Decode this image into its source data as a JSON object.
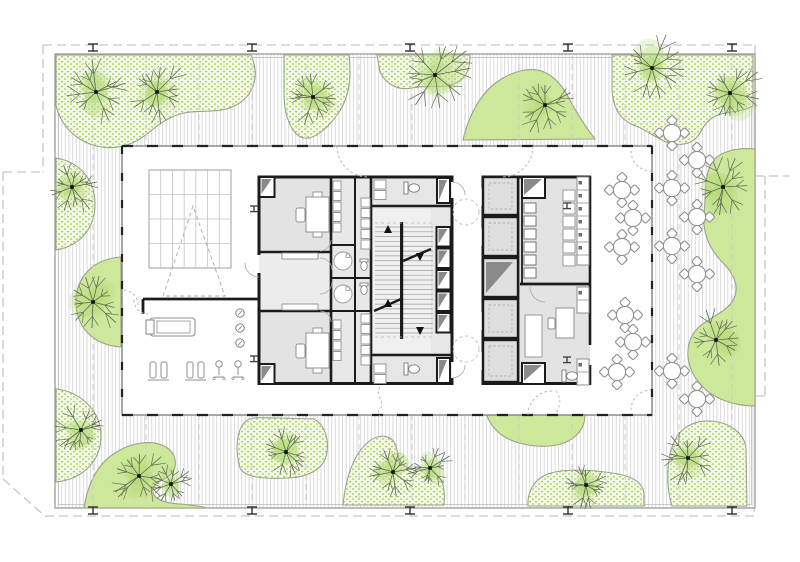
{
  "meta": {
    "drawing_type": "architectural-floor-plan",
    "view": "typical tower floor with landscaped roof terrace",
    "canvas": {
      "w": 800,
      "h": 562
    }
  },
  "palette": {
    "paper": "#ffffff",
    "hatch_line": "#d5d5d5",
    "deck_edge": "#9b9b9b",
    "deck_edge_inner": "#bdbdbd",
    "property_line": "#c6c6c6",
    "grid_dash": "#cccccc",
    "wall_black": "#1b1b1b",
    "facade_gray": "#8a8a8a",
    "facade_dash": "#222222",
    "room_gray": "#e3e3e3",
    "room_gray_light": "#ececec",
    "stair_fill": "#f0f0f0",
    "furniture_stroke": "#8f8f8f",
    "light_stroke": "#aaaaaa",
    "shaft_dark": "#8a8a8a",
    "arc_dash": "#b8b8b8",
    "green_solid": "#cde79b",
    "green_edge": "#9aa389",
    "stipple_bg": "#f3f8e6",
    "stipple_dot": "#a6cf60",
    "tree_branch": "#5d6750",
    "tree_canopy": "#b7db7a",
    "column_dark": "#2f2f2f"
  },
  "site": {
    "deck": {
      "x": 55,
      "y": 54,
      "w": 700,
      "h": 454
    },
    "property_segments": [
      "M43,45 H755",
      "M755,45 V176",
      "M755,176 H790",
      "M765,176 V396",
      "M765,396 H754",
      "M754,396 V512",
      "M45,516 H754",
      "M43,45 V172",
      "M3,172 H43",
      "M3,172 V479",
      "M3,479 L46,517"
    ],
    "grid_xs": [
      93,
      146,
      199,
      252,
      306,
      359,
      412,
      465,
      519,
      572,
      625,
      679,
      732
    ],
    "perimeter_columns": {
      "xs": [
        93,
        252,
        410,
        568,
        732
      ],
      "top_y": 44,
      "bottom_y": 507
    }
  },
  "landscape": {
    "stipple_areas": [
      "M56,55 L251,55 C260,76 254,94 238,104 C216,117 196,106 172,117 C150,127 144,143 118,147 C92,151 64,136 56,106 Z",
      "M284,55 L349,55 C352,80 348,99 339,112 C330,126 315,140 304,138 C292,136 284,116 284,94 Z",
      "M377,55 L470,55 C470,66 468,76 458,82 C444,90 428,84 412,88 C398,91 386,84 380,72 Z",
      "M612,55 L753,55 L753,106 C738,114 724,110 712,118 C700,126 702,138 688,143 C668,150 652,132 636,126 C618,120 612,104 612,86 Z",
      "M56,158 C80,162 95,180 95,204 C95,228 80,246 56,250 Z",
      "M56,389 C82,392 101,412 101,436 C101,460 84,479 56,482 Z",
      "M240,468 C235,450 236,430 246,421 C252,416 264,418 278,418 L314,419 C324,424 329,438 327,452 C325,468 310,477 288,478 C266,479 245,478 240,468 Z",
      "M343,505 C345,484 351,458 366,444 C376,434 388,434 394,442 C399,449 396,458 402,464 C410,472 428,466 438,476 C444,482 445,494 444,505 Z",
      "M528,506 C527,492 534,479 548,474 C564,468 592,470 612,473 C634,476 644,484 644,495 L644,506 Z",
      "M672,506 C666,488 666,460 674,442 C680,428 694,420 710,421 C728,422 744,432 746,448 L747,506 Z"
    ],
    "solid_areas": [
      "M463,140 C468,118 480,92 500,80 C512,72 530,66 544,72 C558,78 566,92 572,104 C580,118 588,130 595,139 Z",
      "M121,257 C92,259 76,278 76,302 C76,326 92,345 121,347 Z",
      "M84,508 C87,488 95,467 112,455 C130,442 152,439 166,447 C176,453 178,465 172,473 C166,480 155,481 153,489 C151,497 161,503 180,504 C192,505 201,506 206,508 Z",
      "M755,149 C736,147 716,152 710,166 C704,180 706,196 704,214 C702,236 712,252 724,264 C736,276 740,290 732,302 C722,316 700,320 692,336 C684,352 688,370 700,384 C714,400 736,406 755,406 Z",
      "M487,415 L585,415 C585,429 575,441 557,445 C535,449 509,443 497,431 C491,425 488,420 487,415 Z"
    ],
    "trees": [
      [
        96,
        92,
        34
      ],
      [
        157,
        92,
        34
      ],
      [
        313,
        97,
        30
      ],
      [
        435,
        75,
        40
      ],
      [
        545,
        105,
        32
      ],
      [
        652,
        68,
        36
      ],
      [
        730,
        93,
        36
      ],
      [
        72,
        187,
        28
      ],
      [
        93,
        302,
        32
      ],
      [
        81,
        430,
        28
      ],
      [
        139,
        476,
        30
      ],
      [
        171,
        484,
        24
      ],
      [
        286,
        452,
        28
      ],
      [
        393,
        472,
        28
      ],
      [
        430,
        468,
        24
      ],
      [
        586,
        485,
        24
      ],
      [
        688,
        458,
        30
      ],
      [
        723,
        187,
        32
      ],
      [
        716,
        340,
        32
      ]
    ]
  },
  "building": {
    "x": 122,
    "y": 146,
    "w": 530,
    "h": 269
  },
  "interior": {
    "fills": [
      [
        259,
        176,
        72,
        76,
        "#e3e3e3"
      ],
      [
        259,
        252,
        72,
        59,
        "#ececec"
      ],
      [
        259,
        311,
        72,
        74,
        "#e3e3e3"
      ],
      [
        331,
        176,
        40,
        209,
        "#e8e8e8"
      ],
      [
        371,
        176,
        81,
        209,
        "#e6e6e6"
      ],
      [
        373,
        209,
        58,
        144,
        "#f0f0f0"
      ],
      [
        483,
        176,
        107,
        209,
        "#e3e3e3"
      ]
    ],
    "walls": [
      [
        259,
        176,
        259,
        255,
        3
      ],
      [
        259,
        273,
        259,
        385,
        3
      ],
      [
        331,
        176,
        331,
        385,
        2.6
      ],
      [
        355,
        176,
        355,
        385,
        2
      ],
      [
        371,
        176,
        371,
        385,
        2.6
      ],
      [
        452,
        176,
        452,
        182,
        3
      ],
      [
        452,
        198,
        452,
        362,
        3
      ],
      [
        452,
        378,
        452,
        385,
        3
      ],
      [
        483,
        176,
        483,
        188,
        3
      ],
      [
        483,
        206,
        483,
        228,
        3
      ],
      [
        483,
        246,
        483,
        312,
        3
      ],
      [
        483,
        330,
        483,
        352,
        3
      ],
      [
        483,
        370,
        483,
        385,
        3
      ],
      [
        518,
        176,
        518,
        385,
        2.6
      ],
      [
        522,
        176,
        522,
        283,
        1.8
      ],
      [
        590,
        176,
        590,
        345,
        2.6
      ],
      [
        590,
        365,
        590,
        385,
        2.6
      ],
      [
        257.5,
        177,
        453.5,
        177,
        3
      ],
      [
        257.5,
        383.5,
        453.5,
        383.5,
        3
      ],
      [
        481.5,
        177,
        591,
        177,
        3
      ],
      [
        481.5,
        383.5,
        591,
        383.5,
        3
      ],
      [
        259,
        252,
        331,
        252,
        2.6
      ],
      [
        259,
        311,
        331,
        311,
        2.6
      ],
      [
        331,
        245,
        355,
        245,
        2
      ],
      [
        331,
        278,
        371,
        278,
        2
      ],
      [
        331,
        311,
        371,
        311,
        2
      ],
      [
        371,
        206,
        452,
        206,
        2.6
      ],
      [
        371,
        355,
        452,
        355,
        2.6
      ],
      [
        483,
        216,
        518,
        216,
        2.2
      ],
      [
        483,
        257,
        518,
        257,
        2.2
      ],
      [
        483,
        298,
        518,
        298,
        2.2
      ],
      [
        483,
        339,
        518,
        339,
        2.2
      ],
      [
        520,
        284,
        590,
        284,
        2.8
      ],
      [
        143,
        299,
        259,
        299,
        2.8
      ],
      [
        143,
        299,
        143,
        314,
        2.8
      ]
    ],
    "shafts_small": [
      [
        259.5,
        177,
        15,
        20
      ],
      [
        259.5,
        364,
        15,
        20
      ],
      [
        437,
        178,
        13,
        25
      ],
      [
        437,
        358,
        13,
        25
      ],
      [
        436.5,
        227,
        14,
        19.5
      ],
      [
        436.5,
        248.5,
        14,
        19.5
      ],
      [
        436.5,
        270,
        14,
        19.5
      ],
      [
        436.5,
        291.5,
        14,
        19.5
      ],
      [
        436.5,
        313,
        14,
        19.5
      ],
      [
        522,
        177,
        23,
        21
      ],
      [
        522,
        363,
        23,
        21
      ]
    ],
    "elevator_cells": [
      [
        483,
        177,
        35,
        38
      ],
      [
        483,
        217,
        35,
        39
      ],
      [
        483,
        299,
        35,
        39
      ],
      [
        483,
        340,
        35,
        42
      ]
    ],
    "elevator_shaft": [
      483,
      258,
      35,
      39
    ],
    "squares_column": {
      "x": 524,
      "w": 12,
      "h": 10,
      "ys": [
        203,
        216,
        229,
        242,
        255,
        268
      ]
    },
    "closet_rects": [
      [
        374,
        180,
        12,
        9
      ],
      [
        374,
        190.5,
        12,
        9
      ],
      [
        374,
        364,
        12,
        9
      ],
      [
        374,
        374.5,
        12,
        9
      ],
      [
        361,
        198,
        9,
        9
      ],
      [
        361,
        208.5,
        9,
        9
      ],
      [
        361,
        219,
        9,
        9
      ],
      [
        361,
        229.5,
        9,
        9
      ],
      [
        361,
        240,
        9,
        9
      ],
      [
        361,
        314,
        9,
        9
      ],
      [
        361,
        324.5,
        9,
        9
      ],
      [
        361,
        335,
        9,
        9
      ],
      [
        361,
        345.5,
        9,
        9
      ],
      [
        361,
        356,
        9,
        9
      ],
      [
        333,
        181,
        8,
        9
      ],
      [
        333,
        191.5,
        8,
        9
      ],
      [
        333,
        202,
        8,
        9
      ],
      [
        333,
        212.5,
        8,
        9
      ],
      [
        333,
        223,
        8,
        9
      ],
      [
        333,
        320,
        8,
        9
      ],
      [
        333,
        330.5,
        8,
        9
      ],
      [
        333,
        341,
        8,
        9
      ],
      [
        333,
        351.5,
        8,
        9
      ],
      [
        563,
        190,
        12,
        11
      ],
      [
        563,
        203,
        12,
        11
      ],
      [
        563,
        216,
        12,
        11
      ],
      [
        563,
        229,
        12,
        11
      ],
      [
        563,
        242,
        12,
        11
      ],
      [
        563,
        255,
        12,
        11
      ],
      [
        525,
        315,
        17,
        42
      ]
    ],
    "kitchen": {
      "col2_top": [
        577,
        177,
        12,
        88
      ],
      "col2_top_divs": [
        190,
        203,
        216,
        229,
        242,
        255
      ],
      "col2_bot1": [
        577,
        287,
        12,
        26
      ],
      "col2_bot1_divs": [
        300
      ],
      "col2_bot2": [
        577,
        359,
        12,
        26
      ],
      "col2_bot2_divs": [
        372
      ],
      "bed": [
        525,
        315,
        17,
        42
      ],
      "table": [
        556,
        308,
        18,
        30
      ],
      "chair": [
        548,
        318,
        7,
        11
      ]
    },
    "stair": {
      "x": 375,
      "y": 227,
      "w": 58,
      "h": 106,
      "treads": 22,
      "stringer": [
        400,
        222,
        3.2,
        117
      ],
      "breaks": [
        [
          374,
          311,
          401,
          299
        ],
        [
          403,
          261,
          431,
          249
        ]
      ],
      "arrows": [
        [
          388,
          230,
          "up"
        ],
        [
          388,
          304,
          "up"
        ],
        [
          420,
          256,
          "down"
        ],
        [
          420,
          330,
          "down"
        ]
      ]
    },
    "skylight": {
      "x": 149,
      "y": 170,
      "w": 82,
      "h": 98,
      "cols": 7,
      "rows": 4,
      "triangle": [
        [
          193,
          206
        ],
        [
          163,
          296
        ],
        [
          225,
          296
        ]
      ]
    },
    "bench": {
      "outer": [
        150,
        318,
        45,
        18
      ],
      "inner": [
        157,
        321,
        33,
        12
      ],
      "cap": [
        146,
        320,
        8,
        14
      ]
    },
    "trio_circles": [
      [
        240,
        313
      ],
      [
        240,
        328
      ],
      [
        240,
        343
      ]
    ],
    "gym": {
      "machines": [
        [
          150,
          362
        ],
        [
          187,
          362
        ]
      ],
      "chairs": [
        [
          219,
          362
        ],
        [
          238,
          362
        ]
      ]
    },
    "desks": [
      [
        306,
        197
      ],
      [
        306,
        333
      ]
    ],
    "shelves": [
      [
        282,
        253,
        36,
        6
      ],
      [
        282,
        304,
        36,
        6
      ]
    ],
    "toilets": [
      [
        408,
        184
      ],
      [
        408,
        365
      ],
      [
        566,
        372
      ]
    ],
    "mini_wc": [
      [
        364,
        262
      ],
      [
        364,
        286
      ]
    ],
    "showers": [
      [
        343,
        261
      ],
      [
        343,
        294
      ]
    ],
    "icolumns": [
      [
        254,
        206
      ],
      [
        254,
        356
      ],
      [
        567,
        203
      ],
      [
        567,
        357
      ]
    ],
    "dashed_circles": [
      [
        466,
        212,
        13
      ],
      [
        466,
        349,
        13
      ]
    ],
    "arcs_dashed": [
      "M337,146 A31,31 0 0 0 368,177",
      "M533,146 A31,31 0 0 1 502,177",
      "M631,151 A20,20 0 0 0 651,171",
      "M631,410 A20,20 0 0 1 651,390",
      "M528,415 A24,24 0 0 1 552,391",
      "M134,300 A14,14 0 0 0 148,314",
      "M138,305 A15,15 0 0 0 123,290",
      "M556,391 C562,399 560,407 556,413",
      "M380,387 C374,395 386,401 380,409 C376,413 380,415 380,416"
    ],
    "arcs_solid": [
      "M332,270 A12,12 0 0 0 320,258",
      "M332,282 A12,12 0 0 1 320,294",
      "M452,182 A13,13 0 0 1 465,195",
      "M452,378 A13,13 0 0 0 465,365",
      "M530,287 A15,15 0 0 0 545,302",
      "M259,277 A14,14 0 0 1 245,263",
      "M331,240 A11,11 0 0 1 320,251",
      "M331,322 A11,11 0 0 0 320,311"
    ],
    "tables_inside": [
      [
        622,
        190
      ],
      [
        633,
        218
      ],
      [
        622,
        247
      ],
      [
        625,
        315
      ],
      [
        633,
        342
      ],
      [
        617,
        372
      ]
    ]
  },
  "furniture_outside": {
    "tables": [
      [
        672,
        133
      ],
      [
        697,
        160
      ],
      [
        672,
        188
      ],
      [
        697,
        217
      ],
      [
        672,
        246
      ],
      [
        697,
        274
      ],
      [
        672,
        371
      ],
      [
        697,
        399
      ]
    ]
  }
}
